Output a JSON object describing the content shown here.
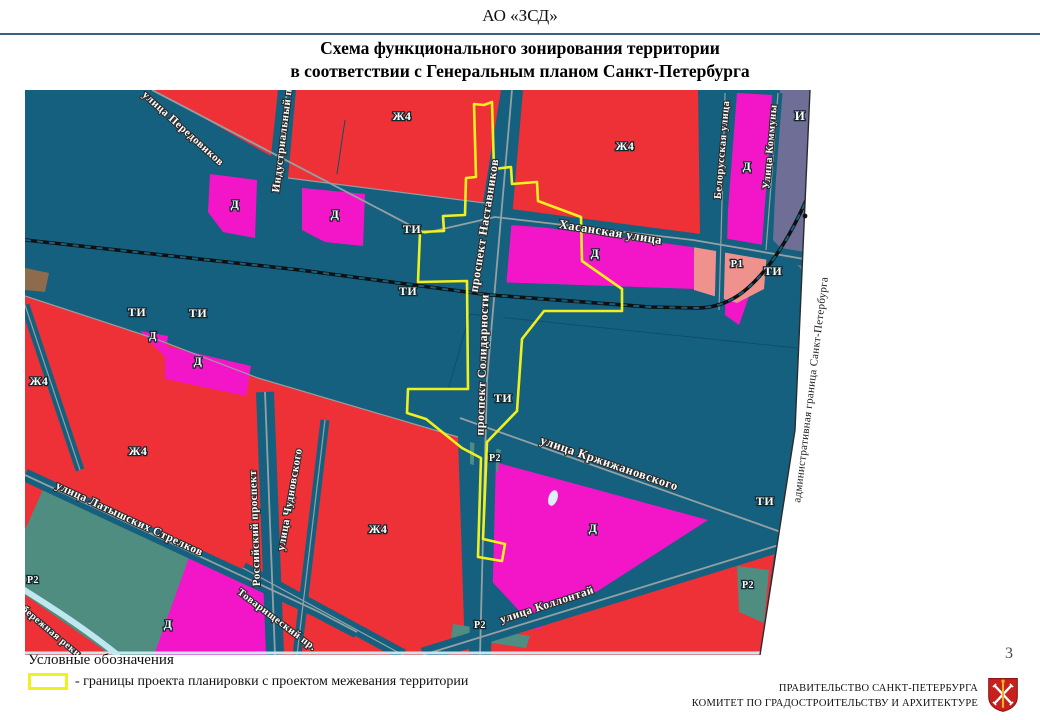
{
  "header": {
    "org": "АО «ЗСД»"
  },
  "title": {
    "line1": "Схема функционального зонирования территории",
    "line2": "в соответствии  с Генеральным планом Санкт-Петербурга"
  },
  "legend": {
    "heading": "Условные обозначения",
    "boundary_item": "- границы проекта планировки с проектом межевания территории"
  },
  "page_number": "3",
  "footer": {
    "line1": "ПРАВИТЕЛЬСТВО САНКТ-ПЕТЕРБУРГА",
    "line2": "КОМИТЕТ ПО ГРАДОСТРОИТЕЛЬСТВУ И АРХИТЕКТУРЕ"
  },
  "map": {
    "boundary_label": "административная граница Санкт-Петербурга",
    "colors": {
      "zh4": "#ee3136",
      "d": "#f316c9",
      "ti": "#15607f",
      "r1": "#ef928d",
      "r2": "#4e8d80",
      "i": "#6e6e96",
      "street": "#95a0a3",
      "rail": "#101010",
      "river": "#bfe7f0",
      "boundary": "#f0f01e"
    },
    "zone_labels": [
      {
        "t": "Ж4",
        "x": 377,
        "y": 30
      },
      {
        "t": "Ж4",
        "x": 600,
        "y": 60
      },
      {
        "t": "Ж4",
        "x": 14,
        "y": 295
      },
      {
        "t": "Ж4",
        "x": 113,
        "y": 365
      },
      {
        "t": "Ж4",
        "x": 353,
        "y": 443
      },
      {
        "t": "Д",
        "x": 210,
        "y": 118
      },
      {
        "t": "Д",
        "x": 310,
        "y": 128
      },
      {
        "t": "Д",
        "x": 722,
        "y": 80
      },
      {
        "t": "Д",
        "x": 570,
        "y": 167
      },
      {
        "t": "Д",
        "x": 128,
        "y": 249,
        "size": 10.5
      },
      {
        "t": "Д",
        "x": 173,
        "y": 275
      },
      {
        "t": "Д",
        "x": 143,
        "y": 538
      },
      {
        "t": "Д",
        "x": 568,
        "y": 442
      },
      {
        "t": "ТИ",
        "x": 112,
        "y": 226
      },
      {
        "t": "ТИ",
        "x": 173,
        "y": 227
      },
      {
        "t": "ТИ",
        "x": 387,
        "y": 143
      },
      {
        "t": "ТИ",
        "x": 383,
        "y": 205
      },
      {
        "t": "ТИ",
        "x": 748,
        "y": 185
      },
      {
        "t": "ТИ",
        "x": 478,
        "y": 312
      },
      {
        "t": "ТИ",
        "x": 740,
        "y": 415
      },
      {
        "t": "Р1",
        "x": 712,
        "y": 177,
        "size": 10.5
      },
      {
        "t": "Р2",
        "x": 8,
        "y": 493,
        "size": 10
      },
      {
        "t": "Р2",
        "x": 470,
        "y": 371,
        "size": 10
      },
      {
        "t": "Р2",
        "x": 455,
        "y": 538,
        "size": 10
      },
      {
        "t": "Р2",
        "x": 723,
        "y": 498,
        "size": 10
      },
      {
        "t": "И",
        "x": 775,
        "y": 30,
        "size": 13
      }
    ],
    "street_labels": [
      {
        "t": "улица Передовиков",
        "x": 156,
        "y": 41,
        "rot": 42,
        "size": 11
      },
      {
        "t": "Индустриальный пр.",
        "x": 261,
        "y": 46,
        "rot": -83,
        "size": 11
      },
      {
        "t": "Хасанская улица",
        "x": 585,
        "y": 146,
        "rot": 9,
        "size": 12.5
      },
      {
        "t": "проспект Наставников",
        "x": 463,
        "y": 136,
        "rot": -81,
        "size": 12
      },
      {
        "t": "проспект Солидарности",
        "x": 461,
        "y": 275,
        "rot": -88,
        "size": 12
      },
      {
        "t": "Белорусская улица",
        "x": 700,
        "y": 60,
        "rot": -85,
        "size": 10.5
      },
      {
        "t": "Улица Коммуны",
        "x": 748,
        "y": 57,
        "rot": -85,
        "size": 10.5
      },
      {
        "t": "улица Кржижановского",
        "x": 583,
        "y": 377,
        "rot": 19,
        "size": 12.5
      },
      {
        "t": "улица Коллонтай",
        "x": 523,
        "y": 518,
        "rot": -18,
        "size": 11.5
      },
      {
        "t": "Российский проспект",
        "x": 233,
        "y": 438,
        "rot": -92,
        "size": 11
      },
      {
        "t": "улица Чудновского",
        "x": 268,
        "y": 410,
        "rot": -80,
        "size": 11
      },
      {
        "t": "Товарищеский пр.",
        "x": 250,
        "y": 532,
        "rot": 37,
        "size": 10.5
      },
      {
        "t": "улица Латышских Стрелков",
        "x": 103,
        "y": 432,
        "rot": 25,
        "size": 11.5
      },
      {
        "t": "набережная реки",
        "x": 20,
        "y": 540,
        "rot": 40,
        "size": 10
      }
    ]
  }
}
